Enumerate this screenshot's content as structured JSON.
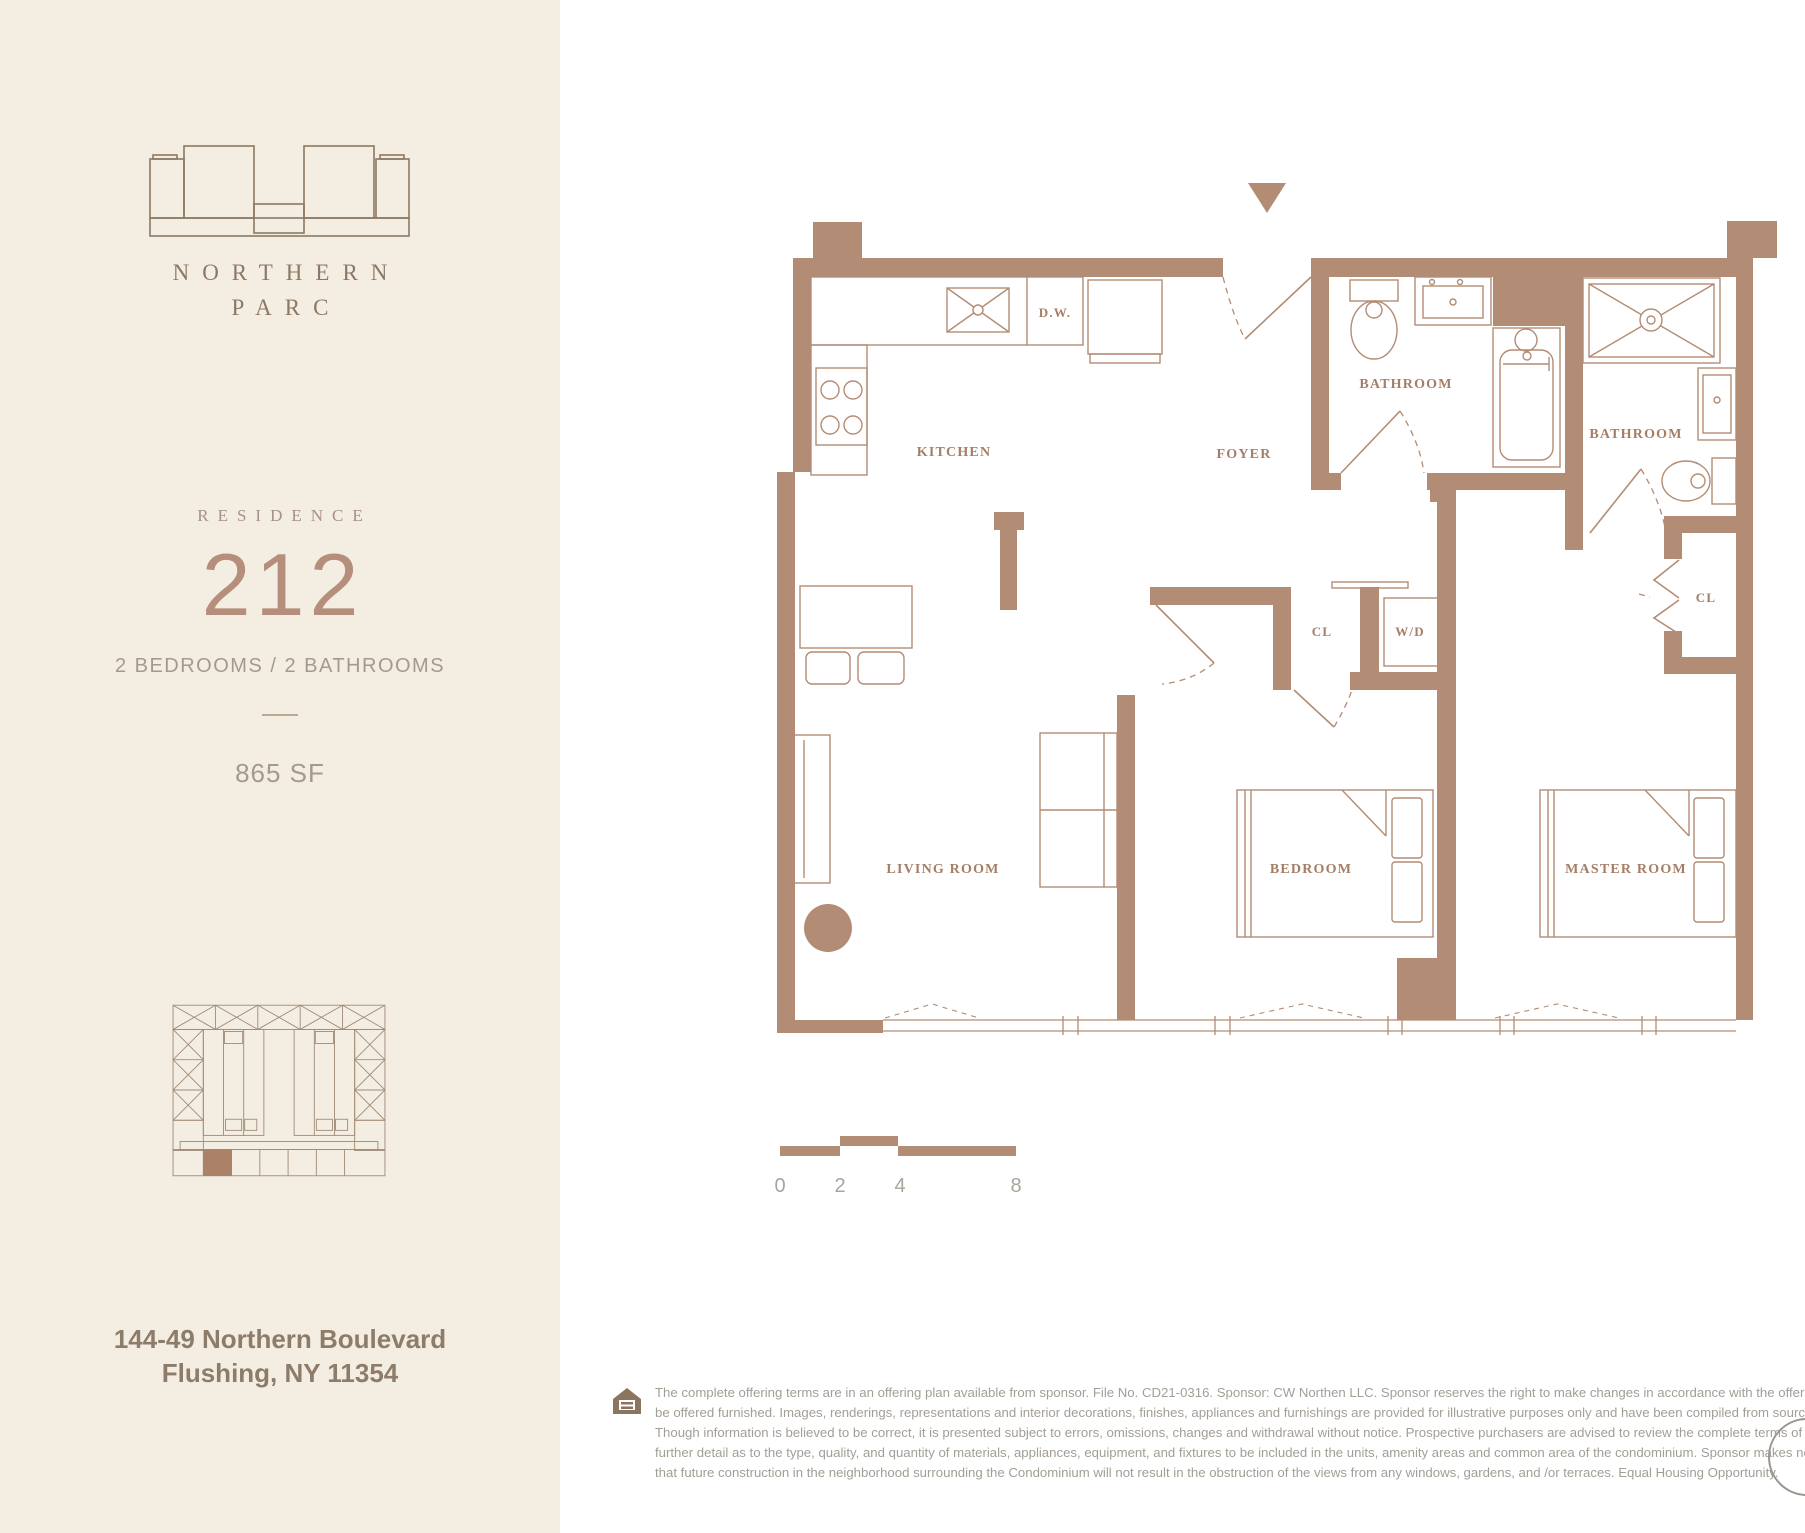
{
  "brand": {
    "line1": "NORTHERN",
    "line2": "PARC"
  },
  "residence": {
    "label": "RESIDENCE",
    "number": "212",
    "specs": "2 BEDROOMS / 2 BATHROOMS",
    "area": "865 SF"
  },
  "address": {
    "line1": "144-49 Northern Boulevard",
    "line2": "Flushing, NY 11354"
  },
  "plan": {
    "labels": {
      "kitchen": "KITCHEN",
      "foyer": "FOYER",
      "bath1": "BATHROOM",
      "bath2": "BATHROOM",
      "living": "LIVING ROOM",
      "bedroom": "BEDROOM",
      "master": "MASTER ROOM",
      "cl_hall": "CL",
      "cl_master": "CL",
      "wd": "W/D",
      "dw": "D.W."
    }
  },
  "scale": {
    "labels": [
      "0",
      "2",
      "4",
      "8"
    ]
  },
  "legal": {
    "lines": [
      "The complete offering terms are in an offering plan available from sponsor. File No. CD21-0316. Sponsor: CW Northen LLC. Sponsor reserves the right to make changes in accordance with the offering plan. Units may",
      "be offered furnished. Images, renderings, representations and interior decorations, finishes, appliances and furnishings are provided for illustrative purposes only and have been compiled from sources deemed reliable.",
      "Though information is believed to be correct, it is presented subject to errors, omissions, changes and withdrawal without notice. Prospective purchasers are advised to review the complete terms of the offering plan for",
      "further detail as to the type, quality, and quantity of materials, appliances, equipment, and fixtures to be included in the units, amenity areas and common area of the condominium. Sponsor makes no representations",
      "that future construction in the neighborhood surrounding the Condominium will not result in the obstruction of the views from any windows, gardens, and /or terraces. Equal Housing Opportunity."
    ]
  },
  "colors": {
    "panel_beige": "#f4eee2",
    "wall_brown": "#b38c75",
    "label_brown": "#a57e66",
    "brand_brown": "#8c7863",
    "residence_number": "#b58f7b",
    "body_gray": "#a39e96"
  }
}
